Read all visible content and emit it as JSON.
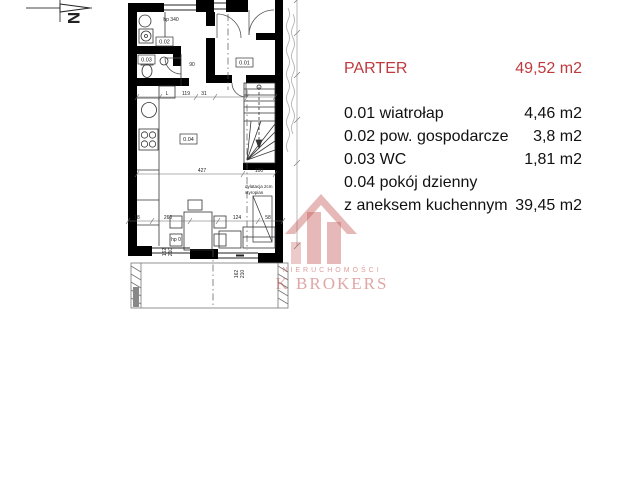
{
  "north": {
    "label": "N"
  },
  "legend": {
    "accent_color": "#bf3a3e",
    "title": "PARTER",
    "title_area": "49,52 m2",
    "rows": [
      {
        "left": "0.01 wiatrołap",
        "right": "4,46 m2"
      },
      {
        "left": "0.02 pow. gospodarcze",
        "right": "3,8 m2"
      },
      {
        "left": "0.03 WC",
        "right": "1,81 m2"
      },
      {
        "left": "0.04 pokój dzienny",
        "right": ""
      },
      {
        "left": "z aneksem kuchennym",
        "right": "39,45 m2"
      }
    ]
  },
  "plan": {
    "room_labels": {
      "r001": "0.01",
      "r002": "0.02",
      "r003": "0.03",
      "r004": "0.04"
    },
    "annotations": {
      "hp_top": "hp 340",
      "hp_bottom": "hp 0",
      "fridge": "L",
      "dilatation_line1": "dylatacja 2cm",
      "dilatation_line2": "styropian"
    },
    "dimensions": {
      "d119": "119",
      "d31": "31",
      "d90": "90",
      "d427": "427",
      "d100": "100",
      "d18": "18",
      "d260": "260",
      "d124": "124",
      "d58": "58",
      "d162": "162",
      "d210": "210"
    }
  },
  "watermark": {
    "color": "#c0504d",
    "line1": "NIERUCHOMOŚCI",
    "line2": "K BROKERS"
  }
}
